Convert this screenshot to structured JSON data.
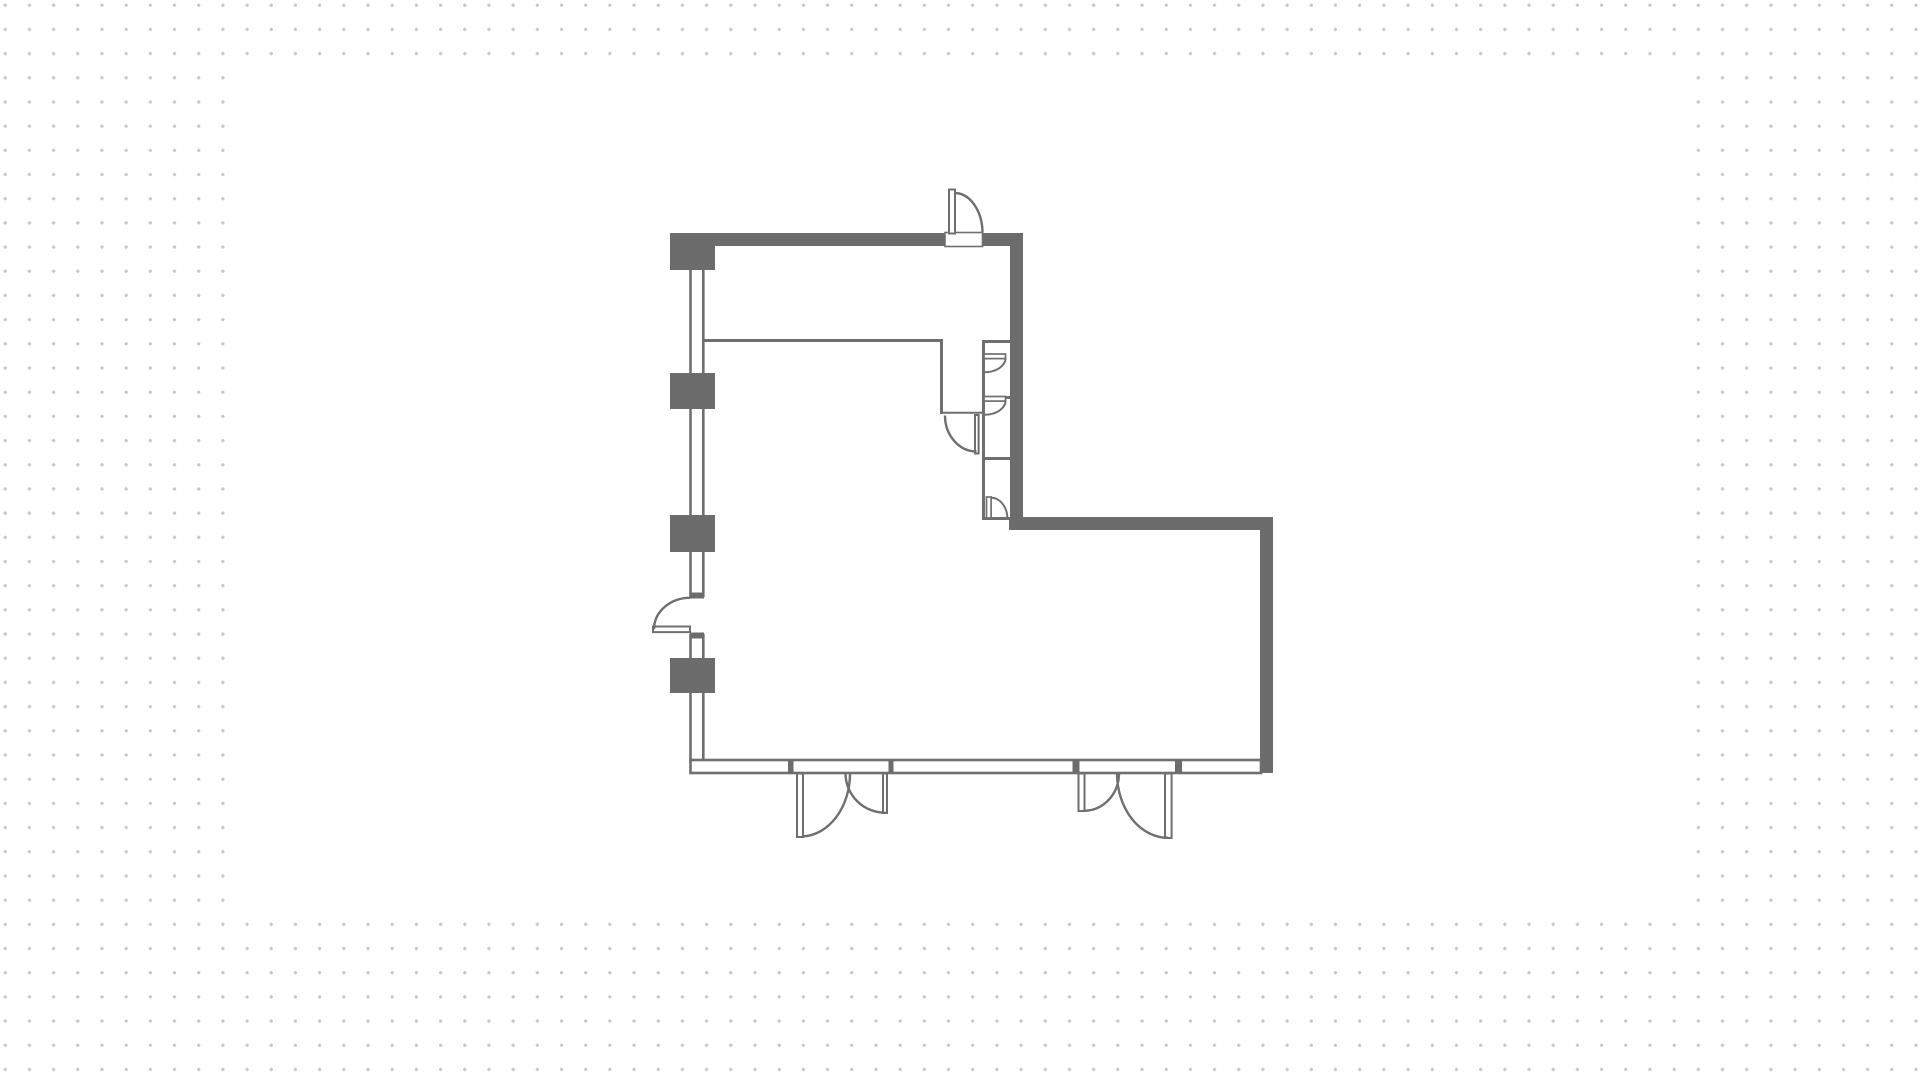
{
  "theme": {
    "dot_color": "#c6c6c6",
    "canvas_color": "#ffffff",
    "wall_color": "#6c6c6c",
    "line_color": "#6f6f6f"
  },
  "canvas": {
    "x": 230,
    "y": 62,
    "width": 1458,
    "height": 847
  },
  "floorplan": {
    "viewbox": "0 0 1920 1078",
    "wall_outlines": [
      {
        "name": "left-wall-segment-1",
        "x": 690.5,
        "y": 266,
        "w": 12.8,
        "h": 110,
        "sw": 2.6
      },
      {
        "name": "left-wall-segment-2",
        "x": 690.5,
        "y": 406,
        "w": 12.8,
        "h": 112,
        "sw": 2.6
      },
      {
        "name": "left-wall-segment-3",
        "x": 690.5,
        "y": 549,
        "w": 12.8,
        "h": 47,
        "sw": 2.6
      },
      {
        "name": "left-wall-segment-4",
        "x": 690.5,
        "y": 635,
        "w": 12.8,
        "h": 26,
        "sw": 2.6
      },
      {
        "name": "left-wall-segment-5",
        "x": 690.5,
        "y": 690,
        "w": 12.8,
        "h": 72,
        "sw": 2.6
      },
      {
        "name": "bottom-wall",
        "x": 690.5,
        "y": 760,
        "w": 570.5,
        "h": 13,
        "sw": 2.6
      }
    ],
    "solid_walls": [
      {
        "name": "top-wall-left-segment",
        "x": 671,
        "y": 233,
        "w": 274,
        "h": 13
      },
      {
        "name": "top-wall-right-segment",
        "x": 983,
        "y": 233,
        "w": 40,
        "h": 13
      },
      {
        "name": "corner-pier",
        "x": 670,
        "y": 233,
        "w": 45,
        "h": 37
      },
      {
        "name": "upper-right-wall",
        "x": 1010,
        "y": 233,
        "w": 13,
        "h": 297
      },
      {
        "name": "lower-room-top-wall",
        "x": 1009,
        "y": 517,
        "w": 264,
        "h": 13
      },
      {
        "name": "lower-room-right-wall",
        "x": 1260,
        "y": 517,
        "w": 13,
        "h": 256
      },
      {
        "name": "wall-pier-2",
        "x": 670,
        "y": 373,
        "w": 45,
        "h": 36
      },
      {
        "name": "wall-pier-3",
        "x": 670,
        "y": 515,
        "w": 45,
        "h": 37
      },
      {
        "name": "wall-pier-4",
        "x": 670,
        "y": 658,
        "w": 45,
        "h": 35
      },
      {
        "name": "entry1-jamb-left",
        "x": 788,
        "y": 760,
        "w": 5.5,
        "h": 13
      },
      {
        "name": "entry1-jamb-right",
        "x": 888.5,
        "y": 760,
        "w": 5,
        "h": 13
      },
      {
        "name": "entry2-jamb-left",
        "x": 1072.5,
        "y": 760,
        "w": 7,
        "h": 13
      },
      {
        "name": "entry2-jamb-right",
        "x": 1175,
        "y": 760,
        "w": 7,
        "h": 13
      },
      {
        "name": "left-door-jamb-top",
        "x": 690,
        "y": 592.5,
        "w": 14,
        "h": 6
      },
      {
        "name": "left-door-jamb-bottom",
        "x": 690,
        "y": 632.5,
        "w": 14,
        "h": 6
      }
    ],
    "thin_lines": [
      {
        "name": "partition-wall-h",
        "x1": 703,
        "y1": 340.5,
        "x2": 943,
        "y2": 340.5,
        "sw": 3
      },
      {
        "name": "partition-wall-v",
        "x1": 941.5,
        "y1": 339,
        "x2": 941.5,
        "y2": 414,
        "sw": 3
      },
      {
        "name": "alcove-threshold",
        "x1": 941,
        "y1": 412.8,
        "x2": 982,
        "y2": 412.8,
        "sw": 2
      },
      {
        "name": "shaft-left-wall",
        "x1": 983.5,
        "y1": 340,
        "x2": 983.5,
        "y2": 519,
        "sw": 3
      },
      {
        "name": "shaft-divider-1",
        "x1": 982,
        "y1": 341.5,
        "x2": 1010,
        "y2": 341.5,
        "sw": 3
      },
      {
        "name": "shaft-divider-2",
        "x1": 982,
        "y1": 397.5,
        "x2": 1010,
        "y2": 397.5,
        "sw": 3
      },
      {
        "name": "shaft-divider-3",
        "x1": 982,
        "y1": 458.5,
        "x2": 1010,
        "y2": 458.5,
        "sw": 3
      },
      {
        "name": "shaft-divider-4",
        "x1": 982,
        "y1": 518.5,
        "x2": 1010,
        "y2": 518.5,
        "sw": 3
      }
    ],
    "door_panels": [
      {
        "name": "top-door-threshold",
        "x": 945,
        "y": 232.5,
        "w": 37.5,
        "h": 14,
        "sw": 1.6
      },
      {
        "name": "top-door-leaf",
        "x": 949,
        "y": 189.5,
        "w": 6,
        "h": 44,
        "sw": 2
      },
      {
        "name": "alcove-door-leaf",
        "x": 975,
        "y": 415,
        "w": 3.6,
        "h": 38.5,
        "sw": 2
      },
      {
        "name": "shaft-door-1-leaf",
        "x": 984,
        "y": 354,
        "w": 21.5,
        "h": 4.6,
        "sw": 1.7
      },
      {
        "name": "shaft-door-2-leaf",
        "x": 984,
        "y": 396.5,
        "w": 21.5,
        "h": 4.6,
        "sw": 1.7
      },
      {
        "name": "shaft-door-3-leaf",
        "x": 986.5,
        "y": 497,
        "w": 4.6,
        "h": 21,
        "sw": 1.7
      },
      {
        "name": "left-door-leaf",
        "x": 653,
        "y": 626.5,
        "w": 37,
        "h": 5.6,
        "sw": 2
      },
      {
        "name": "entry1-left-leaf",
        "x": 797,
        "y": 773.5,
        "w": 6,
        "h": 63.5,
        "sw": 2
      },
      {
        "name": "entry1-right-leaf",
        "x": 883,
        "y": 773.5,
        "w": 4,
        "h": 39.5,
        "sw": 2
      },
      {
        "name": "entry2-left-leaf",
        "x": 1078.5,
        "y": 773.5,
        "w": 6,
        "h": 37.5,
        "sw": 2
      },
      {
        "name": "entry2-right-leaf",
        "x": 1165,
        "y": 773.5,
        "w": 6.6,
        "h": 64.5,
        "sw": 2
      }
    ],
    "door_arcs": [
      {
        "name": "top-door-arc",
        "d": "M 955 193 A 28 40 0 0 1 982.5 232.5",
        "sw": 2.4
      },
      {
        "name": "alcove-door-arc",
        "d": "M 945 415.5 A 31.5 36 0 0 0 976.5 451.5",
        "sw": 2.4
      },
      {
        "name": "shaft-door-1-arc",
        "d": "M 1005.5 358.3 A 21.5 14 0 0 1 984.2 372.3",
        "sw": 2
      },
      {
        "name": "shaft-door-2-arc",
        "d": "M 1005.5 400.8 A 21.5 14 0 0 1 984.2 414.8",
        "sw": 2
      },
      {
        "name": "shaft-door-3-arc",
        "d": "M 990.8 497.6 A 16.5 20.5 0 0 1 1007.3 518",
        "sw": 2
      },
      {
        "name": "left-door-arc",
        "d": "M 654 629.3 A 36 31.5 0 0 1 690 597.8",
        "sw": 2.4
      },
      {
        "name": "entry1-left-arc",
        "d": "M 803 836.5 A 49.5 63 0 0 0 850 773.5",
        "sw": 2.4
      },
      {
        "name": "entry1-right-arc",
        "d": "M 885.5 812.8 A 40 39.5 0 0 1 845.5 773.3",
        "sw": 2.4
      },
      {
        "name": "entry2-left-arc",
        "d": "M 1084.3 810.8 A 35 37.5 0 0 0 1119 773.4",
        "sw": 2.4
      },
      {
        "name": "entry2-right-arc",
        "d": "M 1168 837.8 A 51 64.5 0 0 1 1117 773.4",
        "sw": 2.4
      }
    ]
  }
}
